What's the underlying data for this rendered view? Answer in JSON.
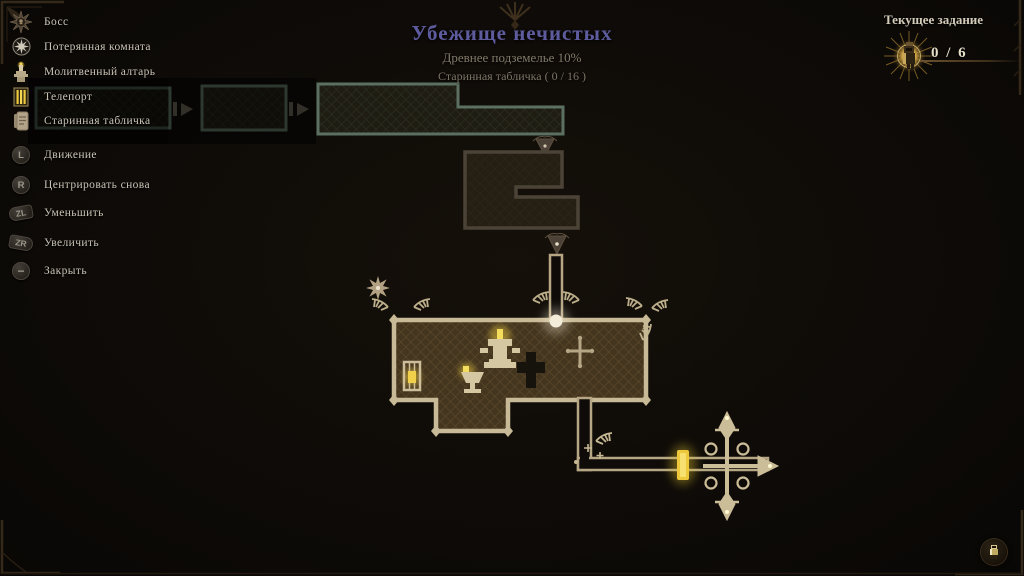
{
  "header": {
    "title": "Убежище нечистых",
    "subtitle_progress": "Древнее подземелье 10%",
    "subtitle_tablets": "Старинная табличка ( 0 / 16 )"
  },
  "quest": {
    "label": "Текущее задание",
    "counter": "0 / 6",
    "icon": "quest-knight-icon"
  },
  "legend": {
    "items": [
      {
        "icon": "boss-icon",
        "label": "Босс"
      },
      {
        "icon": "lost-room-icon",
        "label": "Потерянная комната"
      },
      {
        "icon": "prayer-altar-icon",
        "label": "Молитвенный алтарь"
      },
      {
        "icon": "teleport-icon",
        "label": "Телепорт"
      },
      {
        "icon": "ancient-tablet-icon",
        "label": "Старинная табличка"
      }
    ]
  },
  "controls": {
    "items": [
      {
        "button": "L",
        "label": "Движение"
      },
      {
        "button": "R",
        "label": "Центрировать снова"
      },
      {
        "button": "ZL",
        "label": "Уменьшить"
      },
      {
        "button": "ZR",
        "label": "Увеличить"
      },
      {
        "button": "−",
        "label": "Закрыть"
      }
    ]
  },
  "map": {
    "markers": [
      {
        "name": "lost-room-star-marker"
      },
      {
        "name": "prayer-altar-marker"
      },
      {
        "name": "chalice-marker"
      },
      {
        "name": "lantern-marker"
      },
      {
        "name": "statue-silhouette-marker"
      },
      {
        "name": "cross-waypoint-marker"
      },
      {
        "name": "entry-orb-marker"
      },
      {
        "name": "teleport-marker"
      },
      {
        "name": "compass-rose-ornament"
      }
    ],
    "colors": {
      "explored_wall": "#5b7061",
      "corridor_wall": "#4c4337",
      "hall_wall": "#c9ba97",
      "hall_floor": "#44351f",
      "glow_gold": "#e8c83e",
      "title_accent": "#5e5c9e"
    }
  }
}
